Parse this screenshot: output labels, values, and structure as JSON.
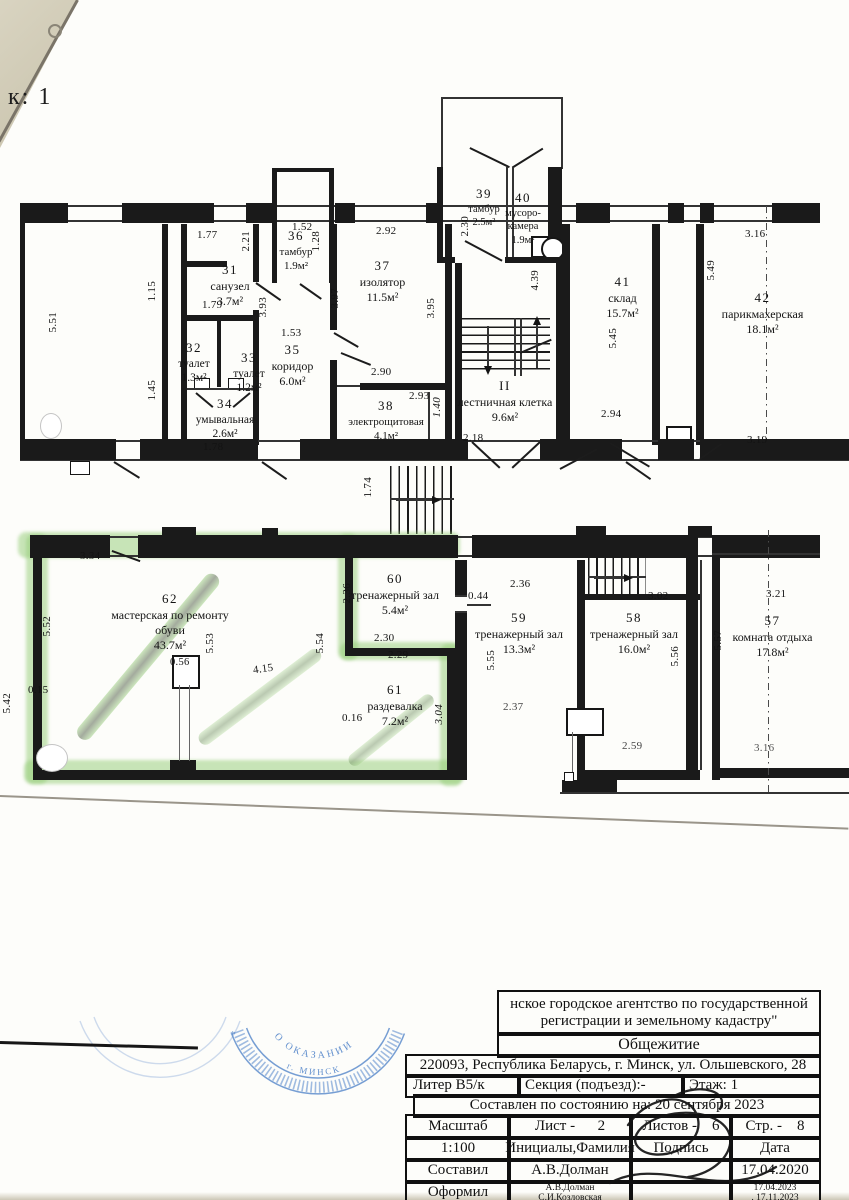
{
  "page": {
    "corner_label": "к: 1"
  },
  "rooms": {
    "r31": {
      "num": "31",
      "name": "санузел",
      "area": "3.7м²"
    },
    "r32": {
      "num": "32",
      "name": "туалет",
      "area": "1.3м²"
    },
    "r33": {
      "num": "33",
      "name": "туалет",
      "area": "1.2м²"
    },
    "r34": {
      "num": "34",
      "name": "умывальная",
      "area": "2.6м²"
    },
    "r35": {
      "num": "35",
      "name": "коридор",
      "area": "6.0м²"
    },
    "r36": {
      "num": "36",
      "name": "тамбур",
      "area": "1.9м²"
    },
    "r37": {
      "num": "37",
      "name": "изолятор",
      "area": "11.5м²"
    },
    "r38": {
      "num": "38",
      "name": "электрощитовая",
      "area": "4.1м²"
    },
    "r39": {
      "num": "39",
      "name": "тамбур",
      "area": "2.5м²"
    },
    "r40": {
      "num": "40",
      "name": "мусоро-камера",
      "area": "1.9м²"
    },
    "r41": {
      "num": "41",
      "name": "склад",
      "area": "15.7м²"
    },
    "r42": {
      "num": "42",
      "name": "парикмахерская",
      "area": "18.1м²"
    },
    "stair": {
      "num": "II",
      "name": "лестничная клетка",
      "area": "9.6м²"
    },
    "r57": {
      "num": "57",
      "name": "комната отдыха",
      "area": "17.8м²"
    },
    "r58": {
      "num": "58",
      "name": "тренажерный зал",
      "area": "16.0м²"
    },
    "r59": {
      "num": "59",
      "name": "тренажерный зал",
      "area": "13.3м²"
    },
    "r60": {
      "num": "60",
      "name": "тренажерный зал",
      "area": "5.4м²"
    },
    "r61": {
      "num": "61",
      "name": "раздевалка",
      "area": "7.2м²"
    },
    "r62": {
      "num": "62",
      "name": "мастерская по ремонту обуви",
      "area": "43.7м²"
    }
  },
  "dims": [
    "5.51",
    "1.77",
    "2.21",
    "1.15",
    "1.79",
    "1.52",
    "1.28",
    "3.93",
    "3.97",
    "1.53",
    "2.92",
    "3.95",
    "2.90",
    "2.93",
    "1.40",
    "1.45",
    "1.78",
    "2.30",
    "4.39",
    "2.18",
    "5.45",
    "2.94",
    "3.16",
    "5.49",
    "3.19",
    "1.74",
    "3.34",
    "5.52",
    "0.15",
    "5.42",
    "0.56",
    "5.53",
    "4.15",
    "5.54",
    "2.36",
    "2.30",
    "2.29",
    "0.16",
    "3.04",
    "0.44",
    "2.36",
    "5.55",
    "2.37",
    "3.02",
    "5.56",
    "2.59",
    "3.21",
    "5.57",
    "3.16"
  ],
  "stamp": {
    "text1": "О ОКАЗАНИИ",
    "text2": "г. МИНСК",
    "star": "*"
  },
  "titleblock": {
    "agency1": "нское городское агентство по государственной",
    "agency2": "регистрации и земельному кадастру\"",
    "building": "Общежитие",
    "address": "220093, Республика Беларусь, г. Минск, ул. Ольшевского, 28",
    "liter": "Литер В5/к",
    "section": "Секция (подъезд):-",
    "floor": "Этаж: 1",
    "as_of": "Составлен по состоянию на: 20 сентября 2023",
    "scale_label": "Масштаб",
    "sheet": "Лист -      2",
    "sheets": "Листов -    6",
    "pagenum": "Стр. -    8",
    "scale": "1:100",
    "initials": "Инициалы,Фамилия",
    "sign": "Подпись",
    "date": "Дата",
    "made_label": "Составил",
    "made_name": "А.В.Долман",
    "made_date": "17.04.2020",
    "drawn_label": "Оформил",
    "drawn_name1": "А.В.Долман",
    "drawn_name2": "С.И.Козловская",
    "drawn_date1": "17.04.2023",
    "drawn_date2": ". 17.11.2023"
  }
}
